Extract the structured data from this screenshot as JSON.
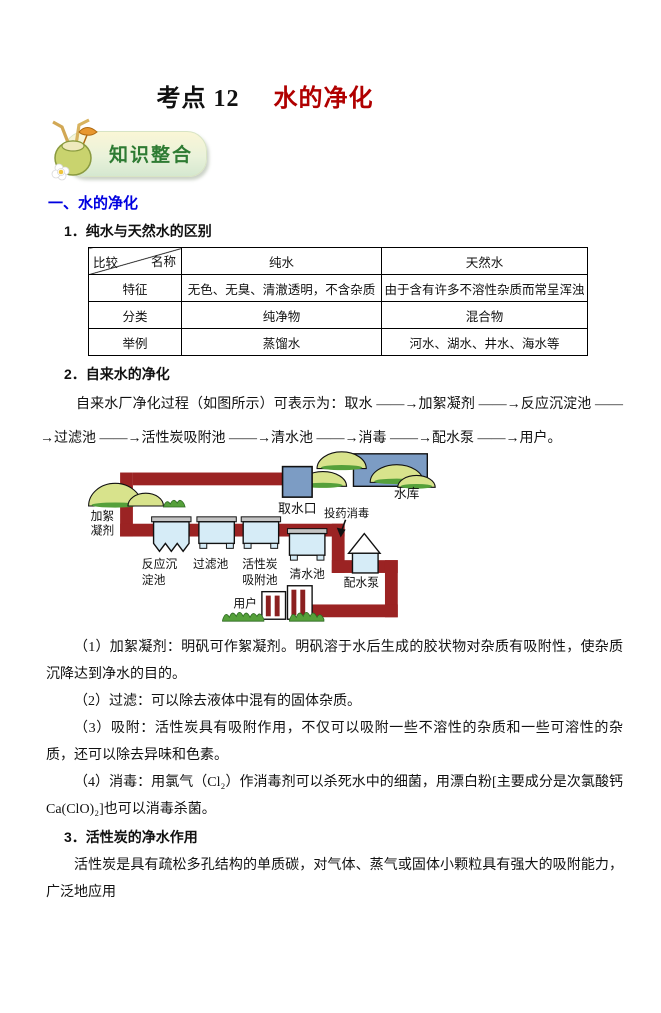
{
  "page": {
    "title_prefix": "考点 12",
    "title_red": "水的净化",
    "badge_label": "知识整合"
  },
  "section1": {
    "heading": "一、水的净化",
    "sub1": "1．纯水与天然水的区别",
    "table": {
      "corner_top_right": "名称",
      "corner_bottom_left": "比较",
      "col_pure": "纯水",
      "col_natural": "天然水",
      "rows": [
        {
          "h": "特征",
          "pure": "无色、无臭、清澈透明，不含杂质",
          "natural": "由于含有许多不溶性杂质而常呈浑浊"
        },
        {
          "h": "分类",
          "pure": "纯净物",
          "natural": "混合物"
        },
        {
          "h": "举例",
          "pure": "蒸馏水",
          "natural": "河水、湖水、井水、海水等"
        }
      ]
    },
    "sub2": "2．自来水的净化",
    "flow_text": "自来水厂净化过程（如图所示）可表示为：取水 ——→加絮凝剂 ——→反应沉淀池 ——→过滤池 ——→活性炭吸附池 ——→清水池 ——→消毒 ——→配水泵 ——→用户。",
    "diagram": {
      "intake": "取水口",
      "reservoir": "水库",
      "flocculant_line1": "加絮",
      "flocculant_line2": "凝剂",
      "dosing": "投药消毒",
      "tank1_line1": "反应沉",
      "tank1_line2": "淀池",
      "tank2": "过滤池",
      "tank3_line1": "活性炭",
      "tank3_line2": "吸附池",
      "tank4": "清水池",
      "pump": "配水泵",
      "users": "用户"
    },
    "points": [
      "（1）加絮凝剂：明矾可作絮凝剂。明矾溶于水后生成的胶状物对杂质有吸附性，使杂质沉降达到净水的目的。",
      "（2）过滤：可以除去液体中混有的固体杂质。",
      "（3）吸附：活性炭具有吸附作用，不仅可以吸附一些不溶性的杂质和一些可溶性的杂质，还可以除去异味和色素。",
      "（4）消毒：用氯气（Cl₂）作消毒剂可以杀死水中的细菌，用漂白粉[主要成分是次氯酸钙 Ca(ClO)₂]也可以消毒杀菌。"
    ],
    "sub3": "3．活性炭的净水作用",
    "carbon_text": "活性炭是具有疏松多孔结构的单质碳，对气体、蒸气或固体小颗粒具有强大的吸附能力，广泛地应用"
  },
  "colors": {
    "title_red": "#b00000",
    "section_blue": "#0000e0",
    "badge_green": "#2e7b33",
    "pipe_red": "#9b2323",
    "tank_blue": "#d6ecf7",
    "water_blue": "#7c9cc4",
    "hill_green": "#d8e38c",
    "grass_green": "#55a03a"
  }
}
